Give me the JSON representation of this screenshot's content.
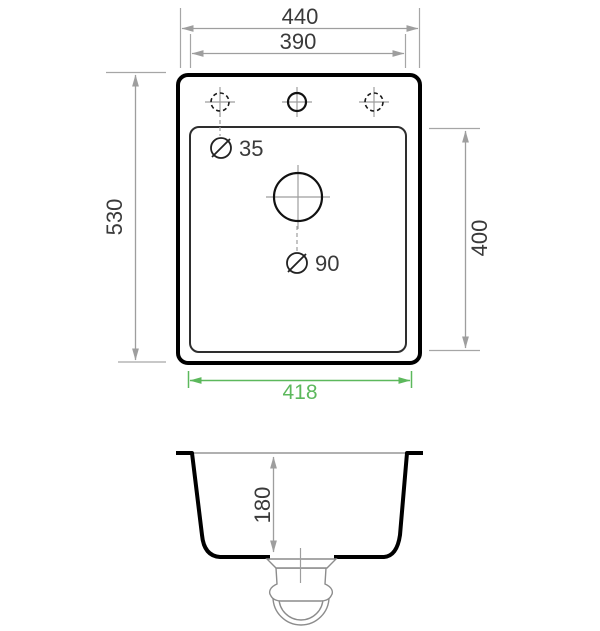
{
  "figure": {
    "type": "sink-technical-drawing",
    "top_view": {
      "dim_outer_width": "440",
      "dim_inner_width": "390",
      "dim_outer_height": "530",
      "dim_inner_height": "400",
      "dim_drainer_width": "418",
      "label_tap_hole_diameter": "35",
      "label_drain_hole_diameter": "90"
    },
    "section_view": {
      "dim_bowl_depth": "180"
    },
    "colors": {
      "outline": "#000000",
      "dimension_line": "#9e9e9e",
      "dimension_text": "#3a3a3a",
      "highlight_green": "#5cb85c",
      "trap_line": "#8c8c8c"
    }
  }
}
